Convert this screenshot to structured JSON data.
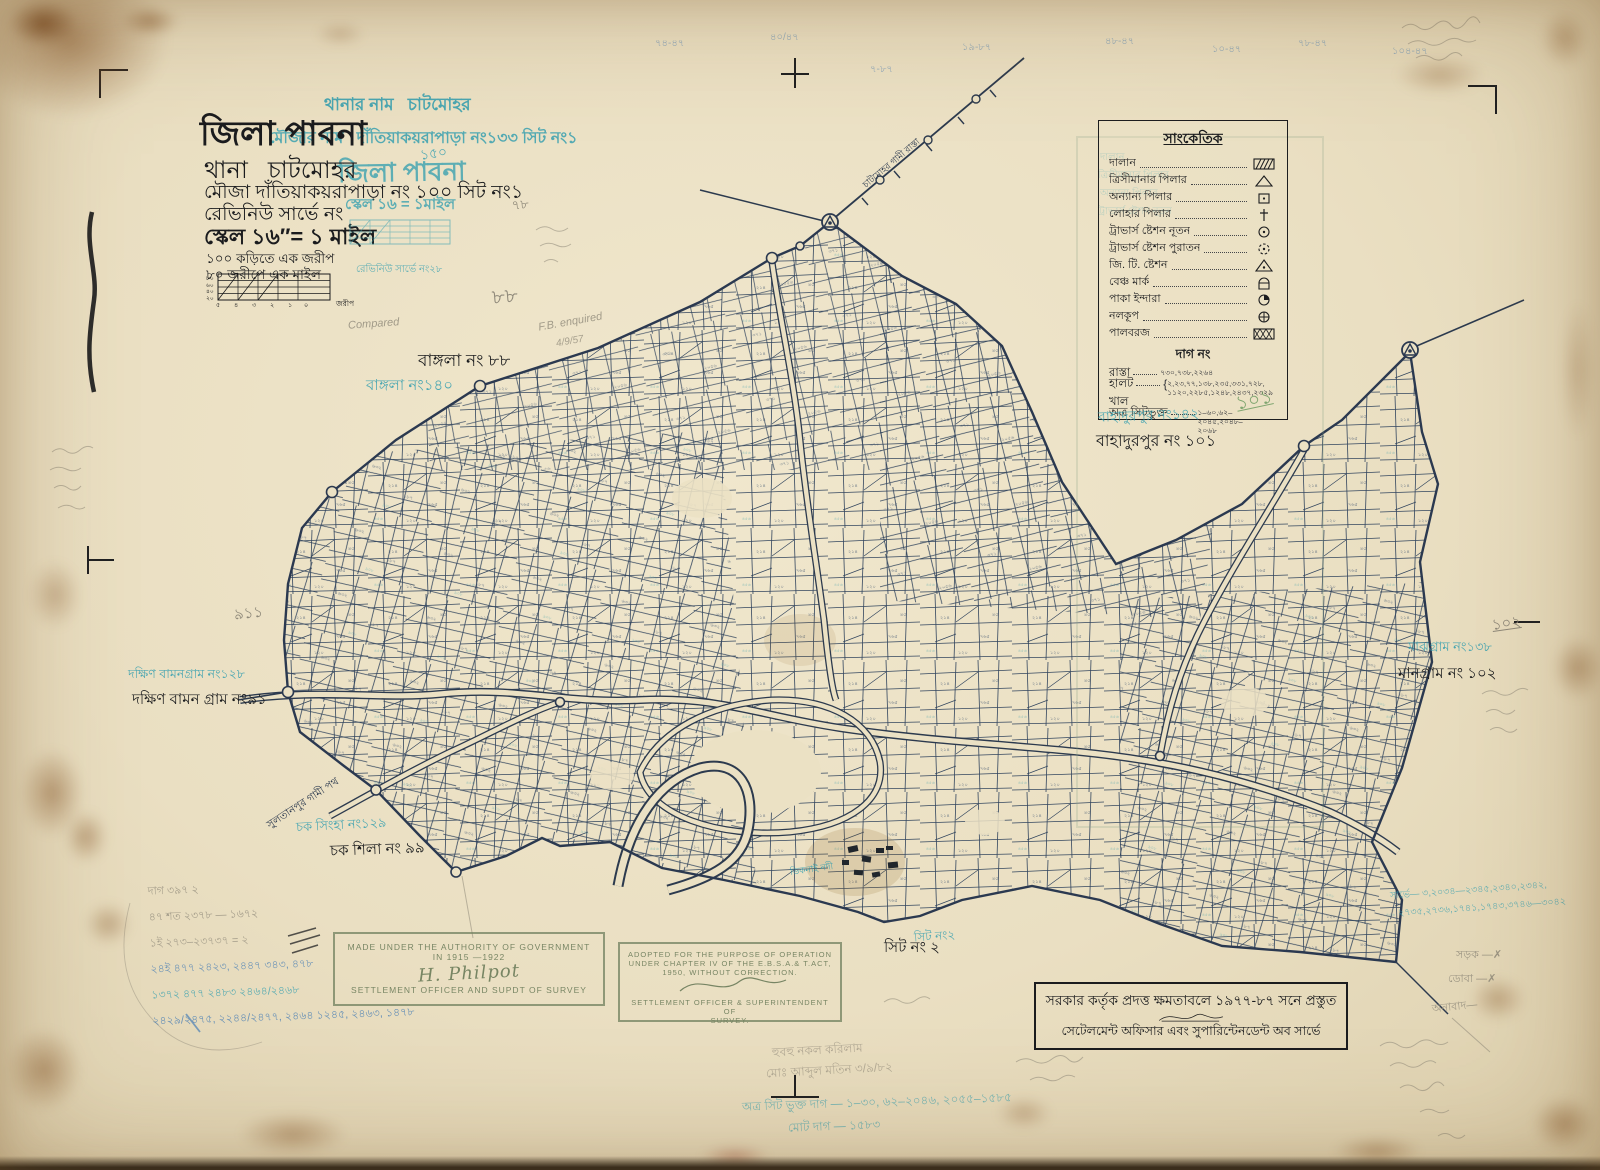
{
  "title_block": {
    "district_line": "জিলা পাবনা",
    "thana_label": "থানা",
    "thana_value": "চাটমোহর",
    "mouza_line": "মৌজা  দাঁতিয়াকয়রাপাড়া নং ১০০ সিট নং১",
    "revenue_line": "রেভিনিউ সার্ভে নং",
    "scale_line": "স্কেল ১৬″= ১ মাইল",
    "chain_line1": "১০০ কড়িতে এক জরীপ",
    "chain_line2": "৮০ জরীপে এক মাইল",
    "diagram_left_labels": [
      "৮০",
      "৬০",
      "৪০",
      "২০"
    ],
    "diagram_bottom_labels": [
      "৫",
      "৪",
      "৩",
      "২",
      "১",
      "০"
    ],
    "diagram_unit": "জরীপ"
  },
  "teal_stamp": {
    "thana_name_label": "থানার নাম",
    "thana_name_value": "চাটমোহর",
    "mouza_name_label": "মৌজার নাম",
    "mouza_name_value": "দাঁতিয়াকয়রাপাড়া নং১৩৩ সিট নং১",
    "district_overlay": "জিলা পাবনা",
    "scale_overlay": "স্কেল ১৬ = ১মাইল",
    "revenue_overlay": "রেভিনিউ সার্ভে নং২৮"
  },
  "legend": {
    "title": "সাংকেতিক",
    "items": [
      {
        "label": "দালান",
        "symbol": "building-hatch"
      },
      {
        "label": "ত্রিসীমানার পিলার",
        "symbol": "triangle"
      },
      {
        "label": "অন্যান্য পিলার",
        "symbol": "square-dot"
      },
      {
        "label": "লোহার পিলার",
        "symbol": "dagger"
      },
      {
        "label": "ট্রাভার্স ষ্টেশন নূতন",
        "symbol": "circle-dot"
      },
      {
        "label": "ট্রাভার্স ষ্টেশন পুরাতন",
        "symbol": "dashed-circle-dot"
      },
      {
        "label": "জি. টি. ষ্টেশন",
        "symbol": "triangle-dot"
      },
      {
        "label": "বেঞ্চ মার্ক",
        "symbol": "benchmark"
      },
      {
        "label": "পাকা ইন্দারা",
        "symbol": "quarter-circle"
      },
      {
        "label": "নলকূপ",
        "symbol": "circle-cross"
      },
      {
        "label": "পালবরজ",
        "symbol": "crosshatch-rect"
      }
    ],
    "dag_heading": "দাগ নং",
    "rasta_label": "রাস্তা",
    "rasta_value": "৭৩০,৭৩৮,২২৬৪",
    "halot_label": "হালট",
    "halot_value1": "২,২৩,৭৭,১৩৮,২৩৫,৩৩১,৭২৮,",
    "halot_value2": "১১২০,২২৮৫,১২৪৮,২৪৩৭,২৩২৯",
    "khal_label": "খাল",
    "atra_label": "অত্র সিটভুক্ত",
    "atra_value1": "১–৬০,৬২–২০৪৫,২০৪৮–",
    "atra_value2": "২০৬৮",
    "green_number": "১০১"
  },
  "map_labels": {
    "bangla_black": "বাঙ্গলা নং ৮৮",
    "bangla_teal": "বাঙ্গলা নং১৪০",
    "bahadurpur_teal": "বাহাদুরপুর নং১৪২",
    "bahadurpur_black": "বাহাদুরপুর নং ১০১",
    "majhgram_teal": "মাঝগ্রাম নং১৩৮",
    "mangram_black": "মানগ্রাম নং ১০২",
    "dakshin_teal": "দক্ষিণ বামনগ্রাম নং১২৮",
    "dakshin_black": "দক্ষিণ বামন গ্রাম নং৯১",
    "chak_teal": "চক সিংহা নং১২৯",
    "chak_black": "চক শিলা নং ৯৯",
    "sheet_black": "সিট নং ২",
    "sheet_teal": "সিট নং২"
  },
  "roads": {
    "ne_road": "চাটমোহর গামী রাস্তা",
    "sw_road": "সুলতানপুর গামী পথ",
    "river": "ডিকনাই নদী"
  },
  "stamp_made": {
    "line1": "MADE UNDER THE AUTHORITY OF GOVERNMENT IN 1915 —1922",
    "signature": "H. Philpot",
    "line2": "SETTLEMENT OFFICER AND SUPDT OF SURVEY"
  },
  "stamp_adopted": {
    "line1": "ADOPTED FOR THE PURPOSE OF OPERATION",
    "line2": "UNDER CHAPTER IV OF THE E.B.S.A.& T.ACT,",
    "line3": "1950, WITHOUT CORRECTION.",
    "line4": "SETTLEMENT OFFICER & SUPERINTENDENT OF",
    "line5": "SURVEY."
  },
  "footer_box": {
    "line1": "সরকার কর্তৃক প্রদত্ত ক্ষমতাবলে ১৯৭৭-৮৭ সনে প্রস্তুত",
    "line2": "সেটেলমেন্ট অফিসার এবং সুপারিন্টেনডেন্ট অব সার্ভে"
  },
  "annotations": {
    "top_numbers": [
      "৭৪-৪৭",
      "৪০/৪৭",
      "৭-৮৭",
      "১৯-৮৭",
      "৪৮-৪৭",
      "১০-৪৭",
      "৭৮-৪৭",
      "১০৪-৪৭"
    ],
    "teal_150": "১৫০",
    "pencil_78": "৭৮",
    "pencil_88": "৮৮",
    "pencil_911": "৯১১",
    "pencil_102": "১০২",
    "compared": "Compared",
    "fb_enquired": "F.B. enquired",
    "fb_date": "4/9/57",
    "right_teal_1": "সার্ভে— ৩,২০৩৪—২৩৪৫,২৩৪০,২৩৪২,",
    "right_teal_2": "২৭৩৫,২৭৩৬,১৭৪১,১৭৪৩,৩৭৪৬—৩০৪২",
    "right_pencil_1": "সড়ক —✗",
    "right_pencil_2": "ডোবা —✗",
    "right_pencil_3": "অনাবাদ—",
    "left_rows": [
      "দাগ  ৩৯৭   ২",
      "৪৭ শত  ২৩৭৮ —   ১৬৭২",
      "১ই  ২৭৩–২৩৭৩৭ =  ২",
      "২৪ই  ৪৭৭  ২৪২৩,  ২৪৪৭   ৩৪৩, ৪৭৮",
      "১৩৭২  ৪৭৭   ২৪৮৩   ২৪৬৪/২৪৬৮",
      "২৪২৯/২৪৭৫,  ২২৪৪/২৪৭৭,  ২৪৬৪  ১২৪৫, ২৪৬৩, ১৪৭৮"
    ],
    "bottom_pencil_1": "হুবহু নকল করিলাম",
    "bottom_pencil_2": "মোঃ আব্দুল মতিন   ৩/৯/৮২",
    "bottom_teal_1": "অত্র সিট ভুক্ত দাগ — ১–৩০, ৬২–২০৪৬, ২০৫৫–১৫৮৫",
    "bottom_teal_2": "মোট দাগ — ১৫৮৩"
  }
}
